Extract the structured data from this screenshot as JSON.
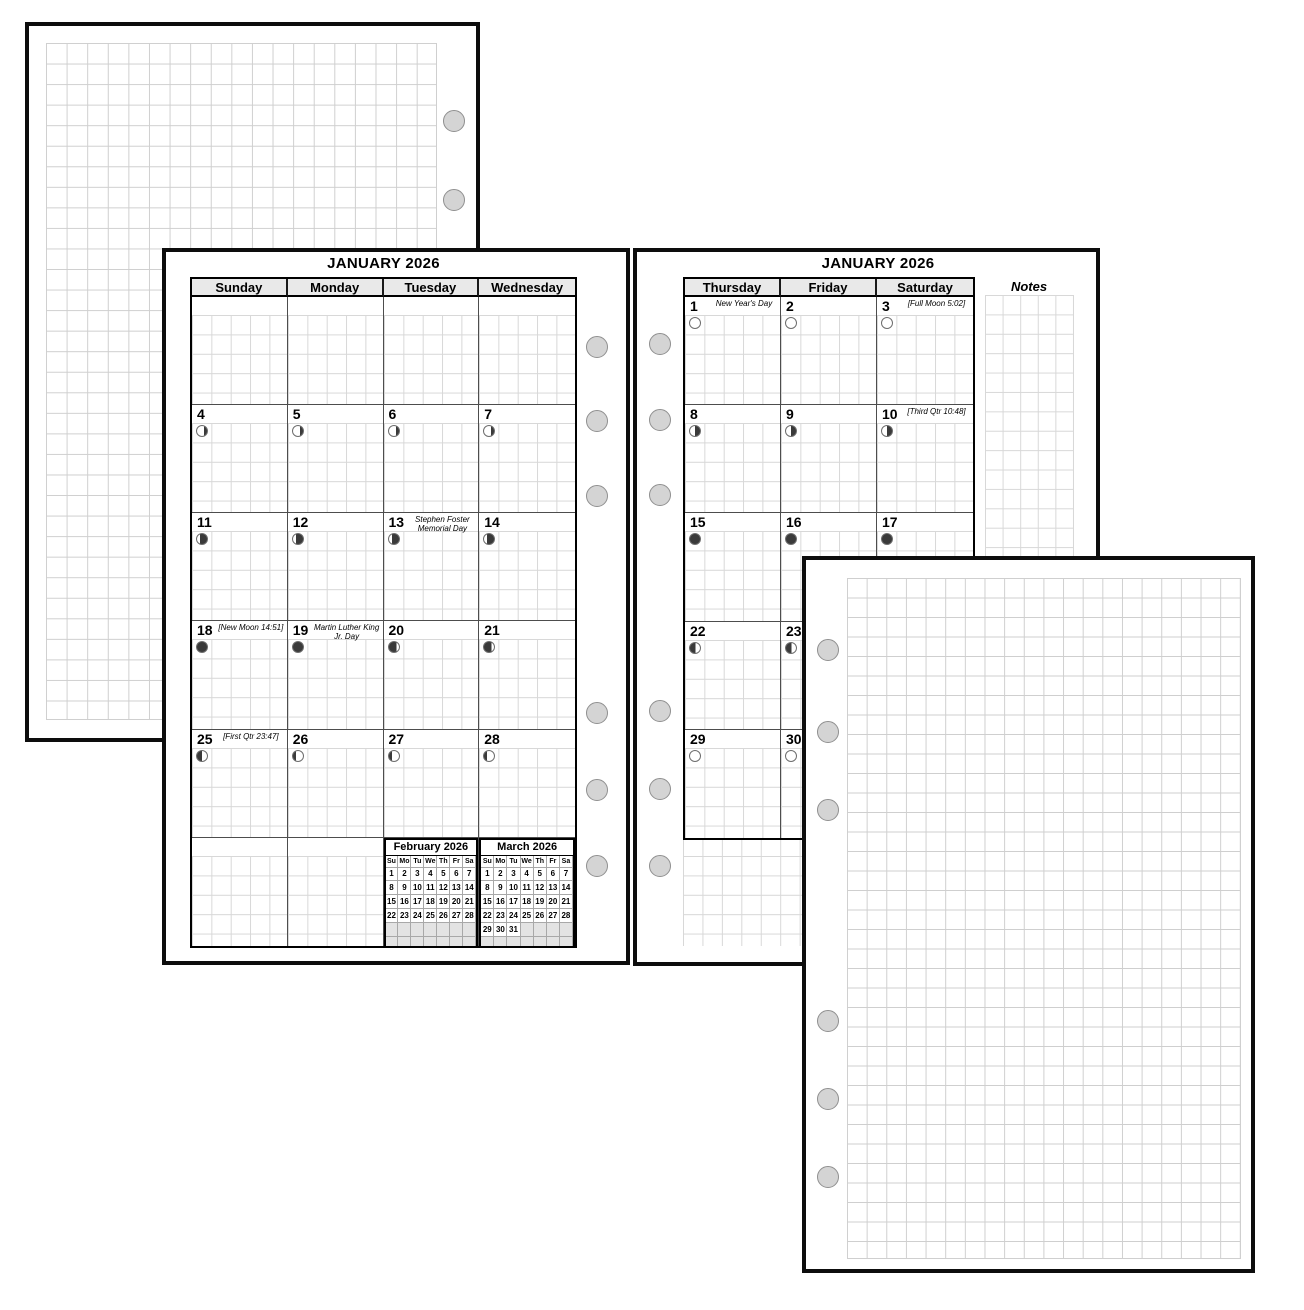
{
  "colors": {
    "page_border": "#0d0d0d",
    "grid_line": "#cfcfcf",
    "cell_grid_line": "#d8d8d8",
    "header_bg": "#e9e9e9",
    "hole_fill": "#d4d4d4",
    "moon_dark": "#3a3a3a",
    "mini_blank_bg": "#e3e3e3"
  },
  "month_left": {
    "title": "JANUARY 2026",
    "weekday_headers": [
      "Sunday",
      "Monday",
      "Tuesday",
      "Wednesday"
    ],
    "rows": [
      [
        null,
        null,
        null,
        null
      ],
      [
        {
          "num": "4",
          "phase": "waning-gibbous"
        },
        {
          "num": "5",
          "phase": "waning-gibbous"
        },
        {
          "num": "6",
          "phase": "waning-gibbous"
        },
        {
          "num": "7",
          "phase": "waning-gibbous"
        }
      ],
      [
        {
          "num": "11",
          "phase": "waning-crescent"
        },
        {
          "num": "12",
          "phase": "waning-crescent"
        },
        {
          "num": "13",
          "phase": "waning-crescent",
          "note": "Stephen Foster Memorial Day"
        },
        {
          "num": "14",
          "phase": "waning-crescent"
        }
      ],
      [
        {
          "num": "18",
          "phase": "new-moon",
          "note": "[New Moon 14:51]"
        },
        {
          "num": "19",
          "phase": "new-moon",
          "note": "Martin Luther King Jr. Day"
        },
        {
          "num": "20",
          "phase": "waxing-crescent"
        },
        {
          "num": "21",
          "phase": "waxing-crescent"
        }
      ],
      [
        {
          "num": "25",
          "phase": "first-quarter",
          "note": "[First Qtr 23:47]"
        },
        {
          "num": "26",
          "phase": "waxing-gibbous"
        },
        {
          "num": "27",
          "phase": "waxing-gibbous"
        },
        {
          "num": "28",
          "phase": "waxing-gibbous"
        }
      ],
      [
        null,
        null,
        null,
        null
      ]
    ],
    "mini_calendars": [
      {
        "title": "February 2026",
        "day_headers": [
          "Su",
          "Mo",
          "Tu",
          "We",
          "Th",
          "Fr",
          "Sa"
        ],
        "cells": [
          "1",
          "2",
          "3",
          "4",
          "5",
          "6",
          "7",
          "8",
          "9",
          "10",
          "11",
          "12",
          "13",
          "14",
          "15",
          "16",
          "17",
          "18",
          "19",
          "20",
          "21",
          "22",
          "23",
          "24",
          "25",
          "26",
          "27",
          "28",
          "",
          "",
          "",
          "",
          "",
          "",
          "",
          "",
          "",
          "",
          "",
          "",
          "",
          ""
        ]
      },
      {
        "title": "March 2026",
        "day_headers": [
          "Su",
          "Mo",
          "Tu",
          "We",
          "Th",
          "Fr",
          "Sa"
        ],
        "cells": [
          "1",
          "2",
          "3",
          "4",
          "5",
          "6",
          "7",
          "8",
          "9",
          "10",
          "11",
          "12",
          "13",
          "14",
          "15",
          "16",
          "17",
          "18",
          "19",
          "20",
          "21",
          "22",
          "23",
          "24",
          "25",
          "26",
          "27",
          "28",
          "29",
          "30",
          "31",
          "",
          "",
          "",
          "",
          "",
          "",
          "",
          "",
          "",
          "",
          ""
        ]
      }
    ]
  },
  "month_right": {
    "title": "JANUARY 2026",
    "weekday_headers": [
      "Thursday",
      "Friday",
      "Saturday"
    ],
    "notes_label": "Notes",
    "rows": [
      [
        {
          "num": "1",
          "phase": "full-moon",
          "note": "New Year's Day"
        },
        {
          "num": "2",
          "phase": "full-moon"
        },
        {
          "num": "3",
          "phase": "full-moon",
          "note": "[Full Moon 5:02]"
        }
      ],
      [
        {
          "num": "8",
          "phase": "last-quarter"
        },
        {
          "num": "9",
          "phase": "last-quarter"
        },
        {
          "num": "10",
          "phase": "last-quarter",
          "note": "[Third Qtr 10:48]"
        }
      ],
      [
        {
          "num": "15",
          "phase": "new-moon"
        },
        {
          "num": "16",
          "phase": "new-moon"
        },
        {
          "num": "17",
          "phase": "new-moon"
        }
      ],
      [
        {
          "num": "22",
          "phase": "waxing-crescent-2"
        },
        {
          "num": "23",
          "phase": "waxing-crescent-2"
        },
        {
          "num": "24",
          "phase": "waxing-crescent-2"
        }
      ],
      [
        {
          "num": "29",
          "phase": "full-moon"
        },
        {
          "num": "30",
          "phase": "full-moon"
        },
        {
          "num": "31",
          "phase": "full-moon"
        }
      ]
    ]
  }
}
